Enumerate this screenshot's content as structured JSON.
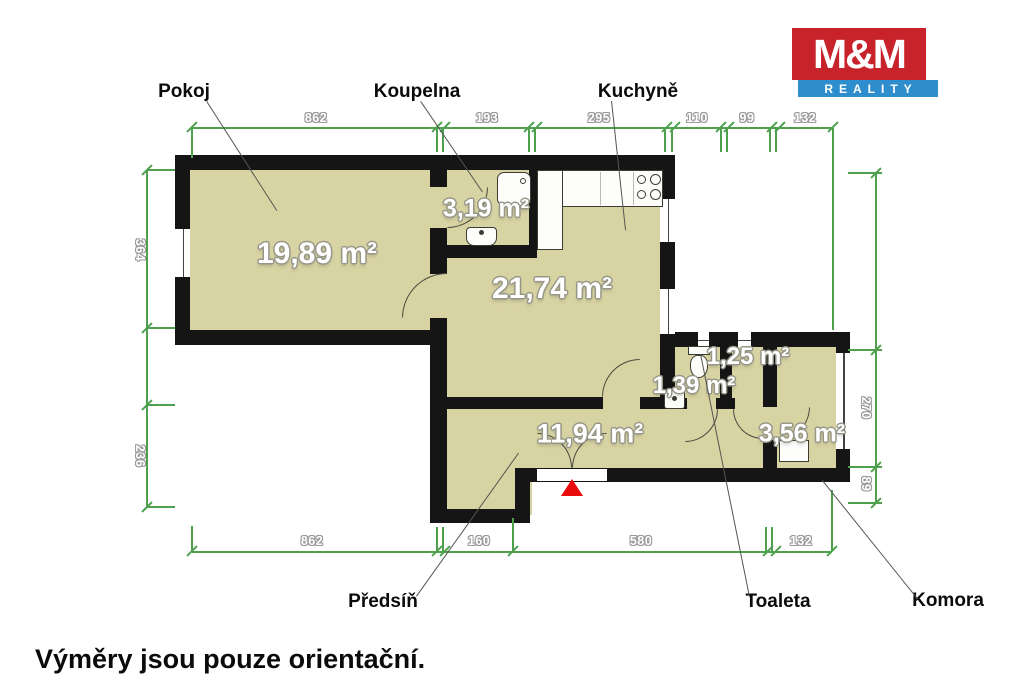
{
  "logo": {
    "top": "M&M",
    "bottom": "REALITY",
    "red": "#c8232b",
    "blue": "#2e8ecd"
  },
  "footer_note": "Výměry jsou pouze orientační.",
  "rooms": [
    {
      "name": "Pokoj",
      "area": "19,89 m²"
    },
    {
      "name": "Koupelna",
      "area": "3,19 m²"
    },
    {
      "name": "Kuchyně",
      "area": "21,74 m²"
    },
    {
      "name": "Předsíň",
      "area": "11,94 m²"
    },
    {
      "name": "Toaleta",
      "area": "1,39 m²"
    },
    {
      "name": "Komora",
      "area": "3,56 m²"
    },
    {
      "name": "",
      "area": "1,25 m²"
    }
  ],
  "dimensions": {
    "top": [
      "862",
      "193",
      "295",
      "110",
      "99",
      "132"
    ],
    "bottom": [
      "862",
      "160",
      "580",
      "132"
    ],
    "left": [
      "364",
      "236"
    ],
    "right": [
      "270",
      "89"
    ]
  },
  "colors": {
    "floor": "#d8d3a2",
    "wall": "#151515",
    "dimension_green": "#4ea04e",
    "entrance_marker": "#e80c0c"
  }
}
